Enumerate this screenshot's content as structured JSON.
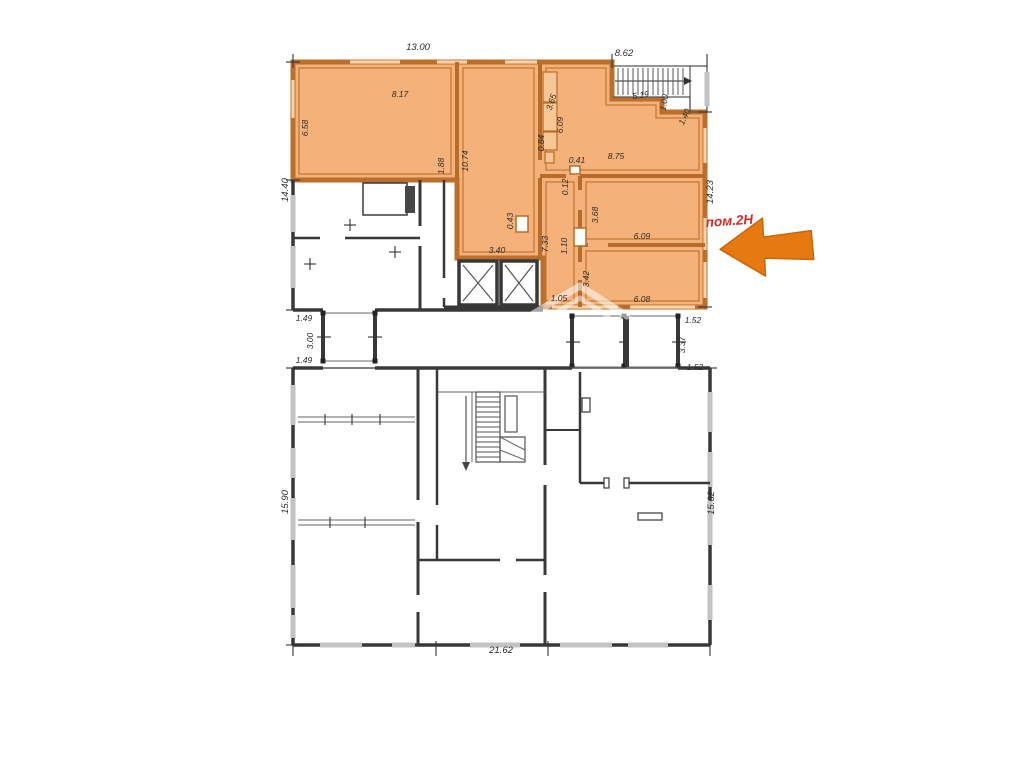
{
  "colors": {
    "highlight_fill": "#f4b179",
    "highlight_border": "#bc6e2b",
    "arrow_fill": "#e67a10",
    "unit_label_red": "#d32a25",
    "plan_line": "#3a3a3a"
  },
  "upper_plan": {
    "unit_label": "пом.2Н",
    "dimensions": [
      {
        "text": "13.00"
      },
      {
        "text": "8.62"
      },
      {
        "text": "8.17"
      },
      {
        "text": "6.58"
      },
      {
        "text": "14.40"
      },
      {
        "text": "1.88"
      },
      {
        "text": "10.74"
      },
      {
        "text": "3.65"
      },
      {
        "text": "6.09"
      },
      {
        "text": "0.84"
      },
      {
        "text": "5.19"
      },
      {
        "text": "1.00"
      },
      {
        "text": "1.40"
      },
      {
        "text": "8.75"
      },
      {
        "text": "0.41"
      },
      {
        "text": "0.12"
      },
      {
        "text": "14.23"
      },
      {
        "text": "3.68"
      },
      {
        "text": "6.09"
      },
      {
        "text": "1.10"
      },
      {
        "text": "7.33"
      },
      {
        "text": "0.43"
      },
      {
        "text": "3.40"
      },
      {
        "text": "3.42"
      },
      {
        "text": "1.05"
      },
      {
        "text": "6.08"
      }
    ]
  },
  "between_plans": {
    "dimensions": [
      {
        "text": "1.49"
      },
      {
        "text": "3.00"
      },
      {
        "text": "1.49"
      },
      {
        "text": "1.52"
      },
      {
        "text": "3.37"
      },
      {
        "text": "1.52"
      }
    ]
  },
  "lower_plan": {
    "dimensions": [
      {
        "text": "15.90"
      },
      {
        "text": "15.62"
      },
      {
        "text": "21.62"
      }
    ]
  }
}
